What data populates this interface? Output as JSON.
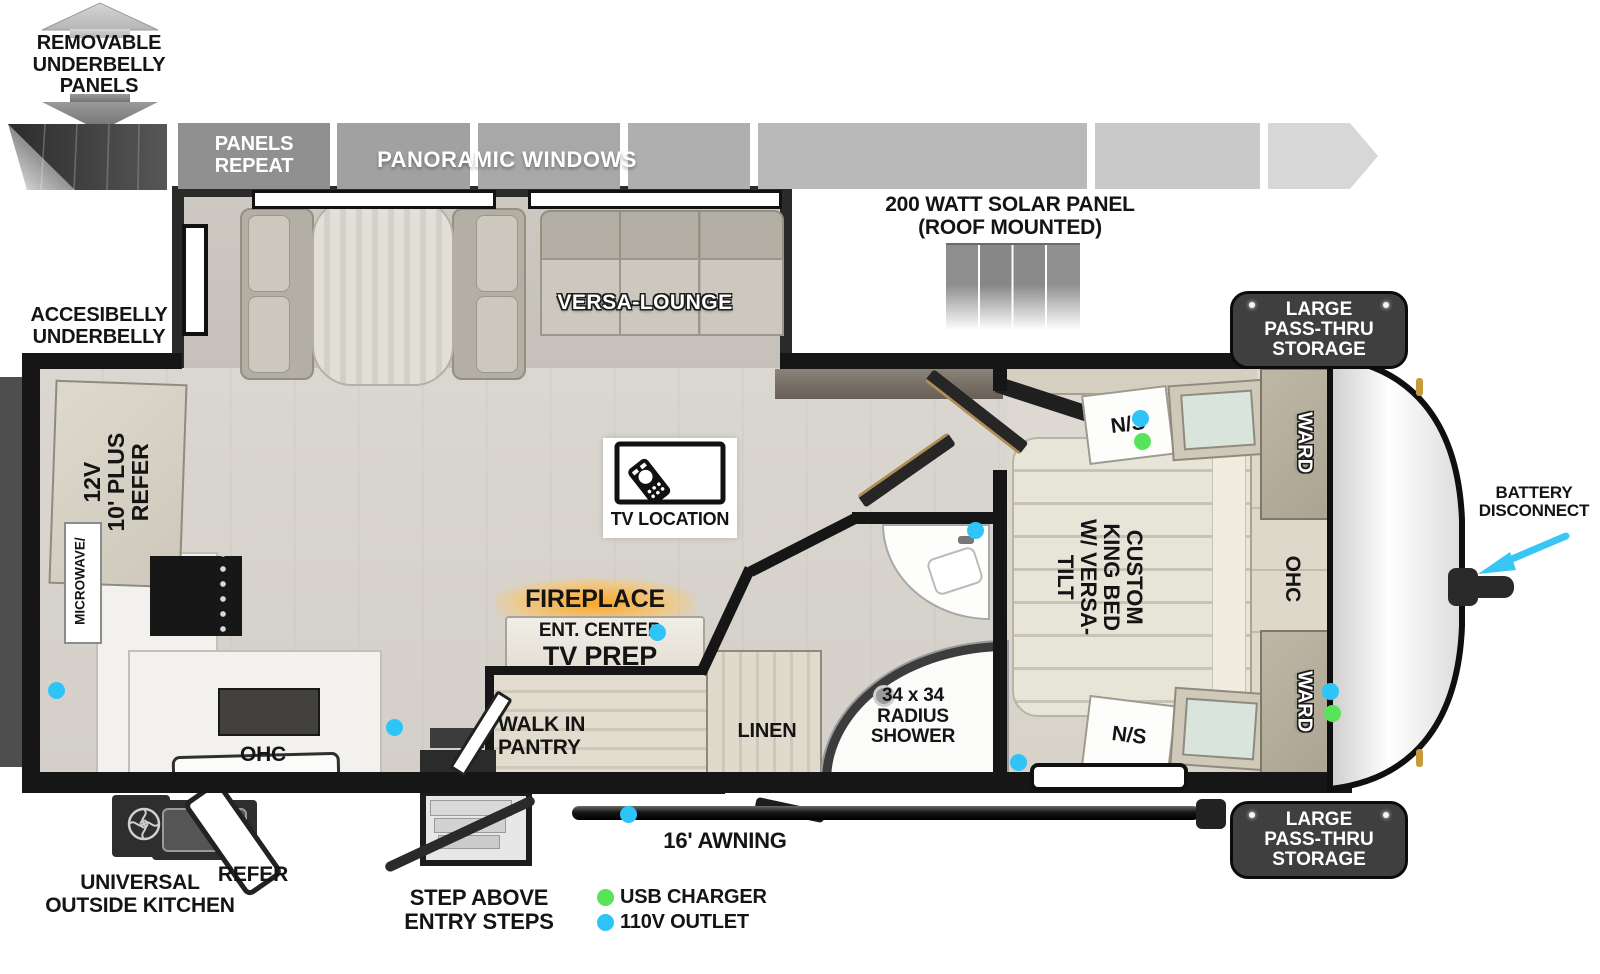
{
  "callouts": {
    "removable_underbelly": "REMOVABLE\nUNDERBELLY\nPANELS",
    "panels_repeat": "PANELS\nREPEAT",
    "panoramic_windows": "PANORAMIC WINDOWS",
    "solar_panel": "200 WATT SOLAR PANEL\n(ROOF MOUNTED)",
    "accessibelly_underbelly": "ACCESIBELLY\nUNDERBELLY",
    "battery_disconnect": "BATTERY\nDISCONNECT",
    "pass_thru_storage_top": "LARGE\nPASS-THRU\nSTORAGE",
    "pass_thru_storage_bottom": "LARGE\nPASS-THRU\nSTORAGE",
    "universal_outside_kitchen": "UNIVERSAL\nOUTSIDE KITCHEN",
    "outside_refer": "REFER",
    "step_above_entry": "STEP ABOVE\nENTRY STEPS",
    "awning": "16' AWNING"
  },
  "interior": {
    "versa_lounge": "VERSA-LOUNGE",
    "tv_location": "TV LOCATION",
    "fireplace": "FIREPLACE",
    "ent_center": "ENT. CENTER",
    "tv_prep": "TV PREP",
    "walk_in_pantry": "WALK IN\nPANTRY",
    "linen": "LINEN",
    "radius_shower": "34 x 34\nRADIUS\nSHOWER",
    "refrigerator": "12V\n10' PLUS\nREFER",
    "microwave": "MICROWAVE/",
    "kitchen_ohc": "OHC",
    "king_bed": "CUSTOM\nKING BED\nW/ VERSA-TILT",
    "bedroom_ohc": "OHC",
    "ward_top": "WARD",
    "ward_bottom": "WARD",
    "nightstand_top": "N/S",
    "nightstand_bottom": "N/S"
  },
  "legend": {
    "usb_charger": "USB CHARGER",
    "outlet_110v": "110V OUTLET"
  },
  "colors": {
    "usb_green": "#59e359",
    "outlet_blue": "#2fc4f7",
    "arrow_cyan": "#38c6f3",
    "wall_black": "#161616",
    "badge_dark": "#3f3f3f",
    "fireplace_glow": "#ffb347"
  }
}
